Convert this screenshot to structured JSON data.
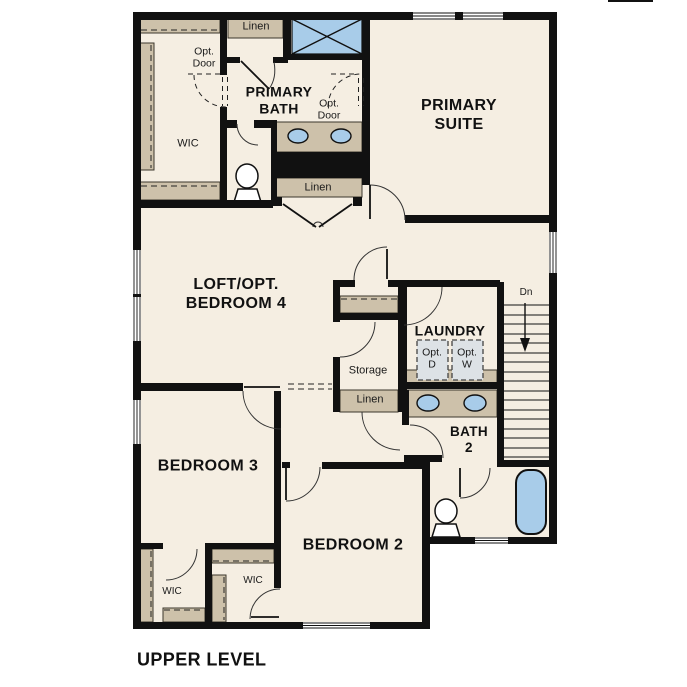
{
  "plan": {
    "level_label": "UPPER LEVEL",
    "rooms": {
      "primary_suite": "PRIMARY\nSUITE",
      "primary_bath": "PRIMARY\nBATH",
      "loft": "LOFT/OPT.\nBEDROOM 4",
      "laundry": "LAUNDRY",
      "bath2": "BATH\n2",
      "bedroom3": "BEDROOM 3",
      "bedroom2": "BEDROOM 2"
    },
    "closets": {
      "wic_primary": "WIC",
      "wic_bedroom3": "WIC",
      "wic_bedroom2": "WIC",
      "linen_top": "Linen",
      "linen_hall": "Linen",
      "linen_mid": "Linen",
      "storage": "Storage"
    },
    "annotations": {
      "opt_door_left": "Opt.\nDoor",
      "opt_door_right": "Opt.\nDoor",
      "opt_dryer": "Opt.\nD",
      "opt_washer": "Opt.\nW",
      "stairs_down": "Dn"
    },
    "colors": {
      "wall": "#111111",
      "floor": "#f5eee2",
      "cabinet": "#cdc1aa",
      "fixture_blue": "#a8cce9",
      "appliance_gray": "#dde2e6",
      "background": "#ffffff"
    }
  }
}
